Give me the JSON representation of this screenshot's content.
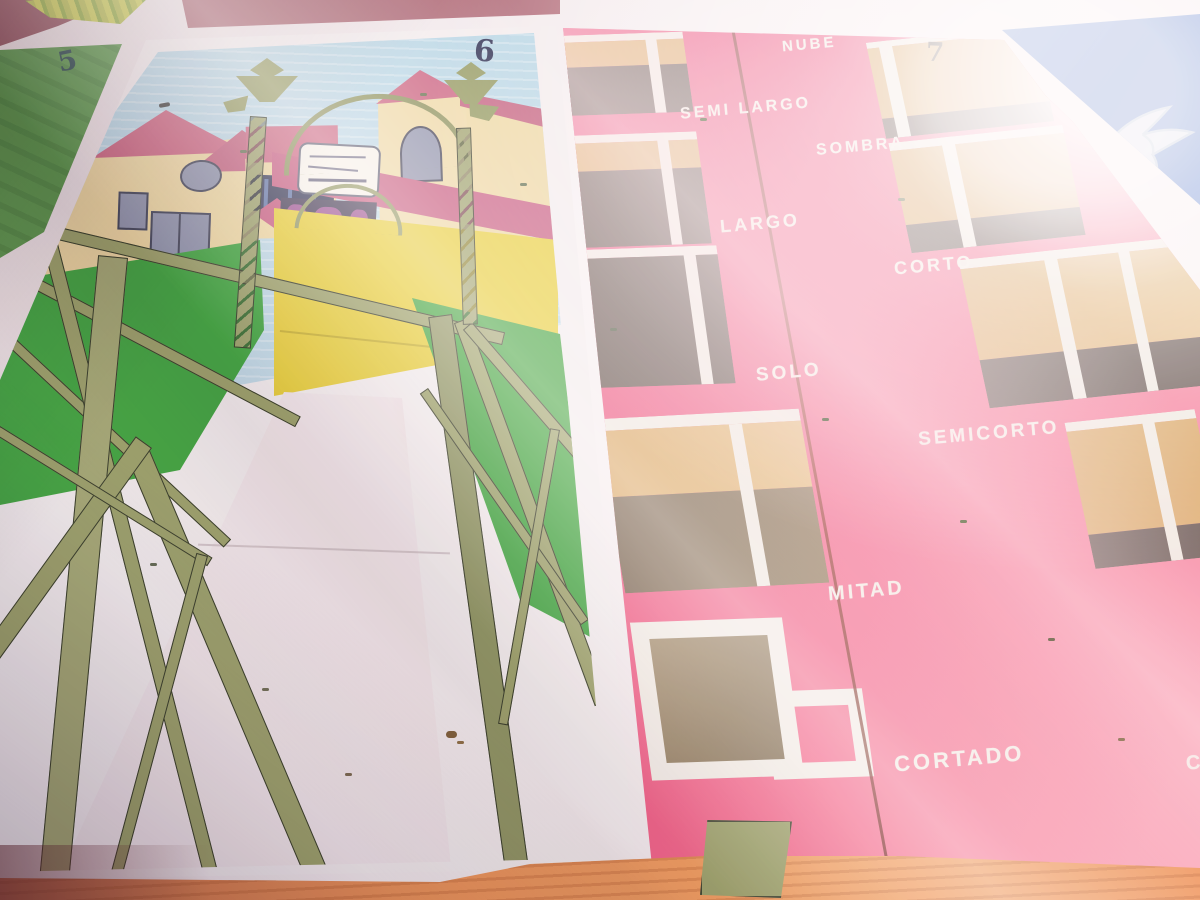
{
  "photo": {
    "subject": "Painted game boards on sunlit pavement: numbered mural panels 5, 6 and 7 plus a blue dove panel",
    "lighting": "strong sunlight with diagonal tree shadows and lens glare"
  },
  "panels": {
    "five": {
      "number": "5"
    },
    "six": {
      "number": "6",
      "subject": "olive truss bridge with ornate lampposts leading to cream buildings with pink roofs under a pale blue sky",
      "sign": "illegible hand-lettered plaque"
    },
    "seven": {
      "number": "7",
      "subject": "coffee cups painted on pink showing Malaga coffee measures",
      "labels": {
        "nube": "NUBE",
        "semi_largo": "SEMI LARGO",
        "sombra": "SOMBRA",
        "largo": "LARGO",
        "corto": "CORTO",
        "solo": "SOLO",
        "semicorto": "SEMICORTO",
        "mitad": "MITAD",
        "cortado": "CORTADO",
        "edge_partial": "C"
      }
    },
    "blue": {
      "subject": "white dove painted on deep blue panel"
    }
  },
  "colors": {
    "pink_panel": "#e8406f",
    "cup_tan": "#d9a55f",
    "cup_dark_brown": "#584842",
    "cup_mid_brown": "#8a7860",
    "stripe_white": "#f0ece3",
    "olive_truss": "#99a167",
    "grass_green": "#3aa53c",
    "panel5_green": "#5e9d4e",
    "cream_wall": "#efd9a2",
    "roof_pink": "#c9607e",
    "yellow_wall": "#e7cf35",
    "sky_blue": "#badbe9",
    "blue_panel": "#2b5cb8",
    "orange_border": "#ea8c50",
    "mauve_band": "#ad6a78"
  }
}
